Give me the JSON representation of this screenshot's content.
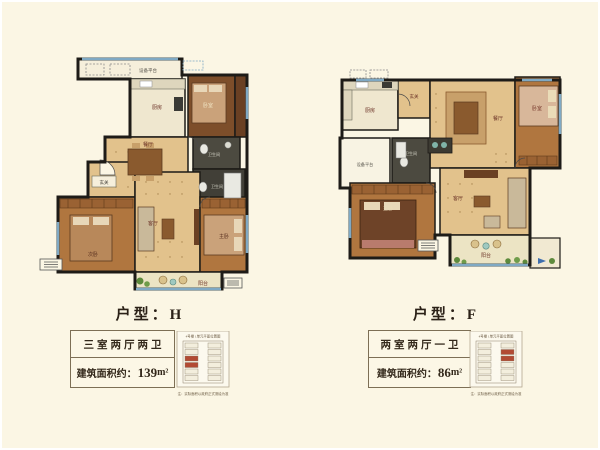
{
  "page": {
    "background": "#fbf6e4"
  },
  "colors": {
    "wall": "#1d1b17",
    "tile_floor": "#e2c28c",
    "wood_floor": "#b0763f",
    "dark_wood_floor": "#7d4e2a",
    "bath_floor": "#4c4a40",
    "window": "#7fa9c4",
    "balcony_floor": "#ece4c4",
    "platform_floor": "#f6efdb",
    "label_dark": "#6b3226",
    "label_light": "#f0e3c2",
    "plant_green": "#5d8a3c",
    "keyplan_highlight": "#b24a33"
  },
  "plans": [
    {
      "unit_title": "户型：H",
      "spec": {
        "layout": "三室两厅两卫",
        "area_label": "建筑面积约：",
        "area_value": "139",
        "area_unit": "m²"
      },
      "key_plan": {
        "caption": "4号楼 1单元平面位置图",
        "note": "注：实际面积以政府正式测绘为准"
      },
      "rooms": {
        "equipment": "设备平台",
        "kitchen": "厨房",
        "bedroom2": "卧室",
        "dining": "餐厅",
        "bath1": "卫生间",
        "bath2": "卫生间",
        "entry": "玄关",
        "bedroom1": "次卧",
        "living": "客厅",
        "master": "主卧",
        "balcony": "阳台"
      }
    },
    {
      "unit_title": "户型：F",
      "spec": {
        "layout": "两室两厅一卫",
        "area_label": "建筑面积约：",
        "area_value": "86",
        "area_unit": "m²"
      },
      "key_plan": {
        "caption": "4号楼 1单元平面位置图",
        "note": "注：实际面积以政府正式测绘为准"
      },
      "rooms": {
        "kitchen": "厨房",
        "entry": "玄关",
        "dining": "餐厅",
        "bedroom2": "卧室",
        "equipment": "设备平台",
        "bath": "卫生间",
        "master": "主卧",
        "living": "客厅",
        "balcony": "阳台"
      }
    }
  ]
}
